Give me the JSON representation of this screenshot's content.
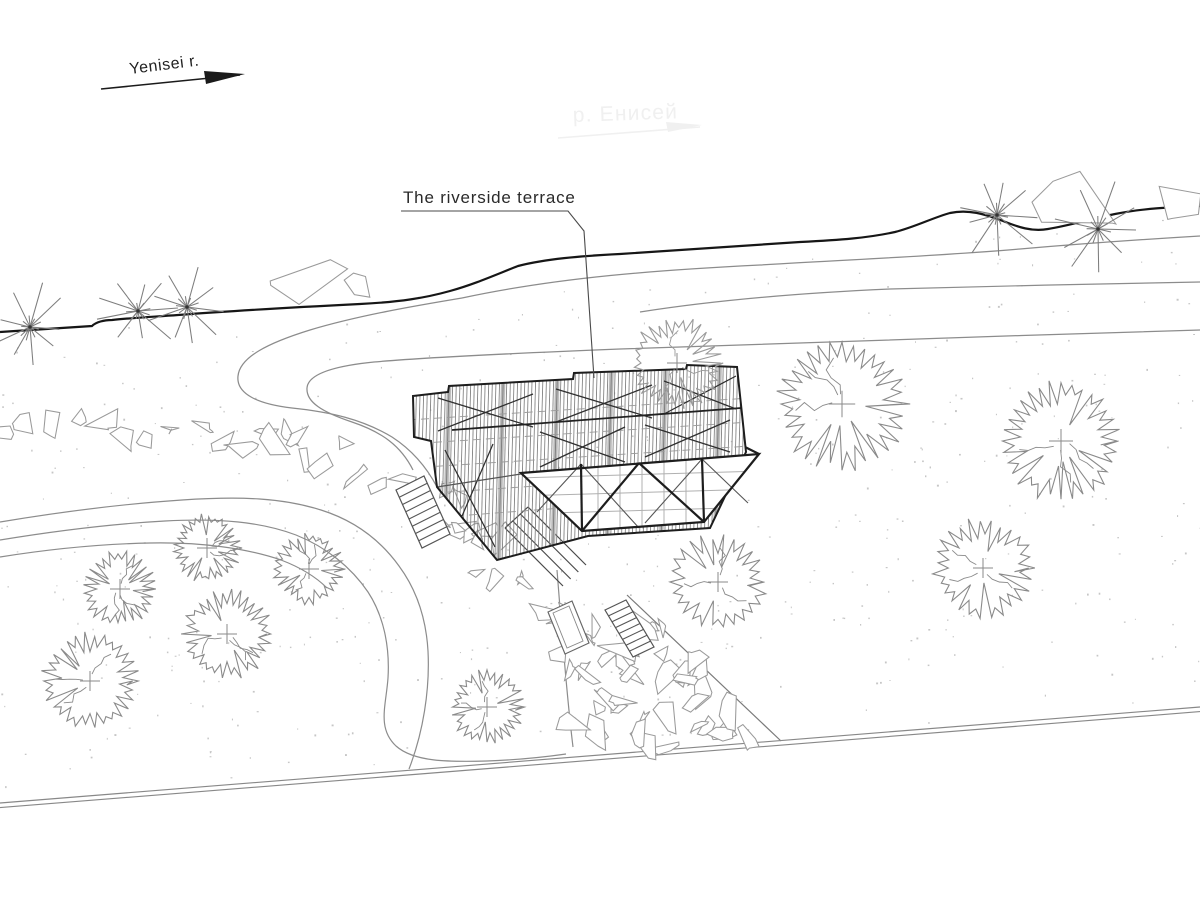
{
  "labels": {
    "river_direction": "Yenisei r.",
    "river_faint": "р. Енисей",
    "terrace": "The riverside terrace"
  },
  "colors": {
    "line_dark": "#161616",
    "line": "#8c8c8c",
    "line_med": "#555555",
    "brace": "#2f2f2f",
    "hatch": "#757575",
    "hatch_band": "#b9b9b9",
    "tree": "#8a8a8a",
    "tree_light": "#9a9a9a",
    "rock": "#9a9a9a",
    "speckle": "#c6c6c6",
    "faint": "#f0f0f0",
    "purlin": "#999999",
    "grid": "#b0b0b0"
  },
  "seeds": {
    "trees": 5,
    "stars": 3,
    "rocks": 13,
    "speckles": 7
  },
  "trees": [
    {
      "x": 677,
      "y": 363,
      "r": 46,
      "light": true
    },
    {
      "x": 842,
      "y": 404,
      "r": 66
    },
    {
      "x": 1061,
      "y": 441,
      "r": 60
    },
    {
      "x": 983,
      "y": 568,
      "r": 50
    },
    {
      "x": 718,
      "y": 582,
      "r": 48
    },
    {
      "x": 207,
      "y": 548,
      "r": 34
    },
    {
      "x": 309,
      "y": 569,
      "r": 35
    },
    {
      "x": 120,
      "y": 589,
      "r": 37
    },
    {
      "x": 227,
      "y": 634,
      "r": 45
    },
    {
      "x": 90,
      "y": 681,
      "r": 48
    },
    {
      "x": 487,
      "y": 707,
      "r": 37
    }
  ],
  "stars": [
    {
      "x": 30,
      "y": 327,
      "r": 44
    },
    {
      "x": 138,
      "y": 311,
      "r": 42
    },
    {
      "x": 187,
      "y": 307,
      "r": 40
    },
    {
      "x": 997,
      "y": 215,
      "r": 42
    },
    {
      "x": 1098,
      "y": 229,
      "r": 46
    }
  ],
  "rock_bands": [
    {
      "pts": [
        [
          0,
          430
        ],
        [
          70,
          426
        ],
        [
          140,
          429
        ],
        [
          210,
          434
        ],
        [
          265,
          440
        ],
        [
          300,
          446
        ]
      ],
      "w": 26,
      "n": 15,
      "rmin": 9,
      "rmax": 16
    },
    {
      "pts": [
        [
          302,
          450
        ],
        [
          352,
          462
        ],
        [
          398,
          480
        ],
        [
          438,
          503
        ],
        [
          470,
          528
        ],
        [
          492,
          548
        ]
      ],
      "w": 34,
      "n": 13,
      "rmin": 8,
      "rmax": 14
    },
    {
      "pts": [
        [
          438,
          528
        ],
        [
          468,
          550
        ],
        [
          500,
          574
        ],
        [
          520,
          590
        ]
      ],
      "w": 30,
      "n": 7,
      "rmin": 7,
      "rmax": 12
    }
  ],
  "riprap": {
    "poly": [
      [
        543,
        575
      ],
      [
        600,
        585
      ],
      [
        627,
        594
      ],
      [
        780,
        740
      ],
      [
        575,
        747
      ],
      [
        557,
        650
      ],
      [
        543,
        600
      ]
    ],
    "count": 46,
    "rmin": 8,
    "rmax": 17
  },
  "rocks_single": [
    {
      "x": 306,
      "y": 283,
      "r": 26,
      "e": 1.7,
      "a": -0.1
    },
    {
      "x": 357,
      "y": 287,
      "r": 13,
      "e": 1.5,
      "a": 0.2
    },
    {
      "x": 1083,
      "y": 198,
      "r": 39,
      "e": 1.6,
      "a": -0.15
    },
    {
      "x": 1162,
      "y": 203,
      "r": 27,
      "e": 1.5,
      "a": -0.1
    }
  ],
  "stairs": [
    {
      "pts": [
        [
          396,
          490
        ],
        [
          424,
          476
        ],
        [
          450,
          534
        ],
        [
          422,
          548
        ]
      ],
      "rungs": 7
    },
    {
      "pts": [
        [
          605,
          610
        ],
        [
          626,
          600
        ],
        [
          654,
          647
        ],
        [
          633,
          657
        ]
      ],
      "rungs": 7
    }
  ],
  "walkway": {
    "a": [
      505,
      528
    ],
    "b": [
      528,
      507
    ],
    "c": [
      563,
      586
    ],
    "d": [
      586,
      565
    ],
    "lines": 4
  },
  "landing": {
    "outer": [
      [
        548,
        612
      ],
      [
        572,
        601
      ],
      [
        589,
        643
      ],
      [
        565,
        654
      ]
    ],
    "inner": [
      [
        553,
        613
      ],
      [
        569,
        606
      ],
      [
        583,
        641
      ],
      [
        567,
        648
      ]
    ]
  },
  "speckles": {
    "count": 640,
    "xmax": 1200,
    "ytop": 215,
    "ybot": 800
  }
}
